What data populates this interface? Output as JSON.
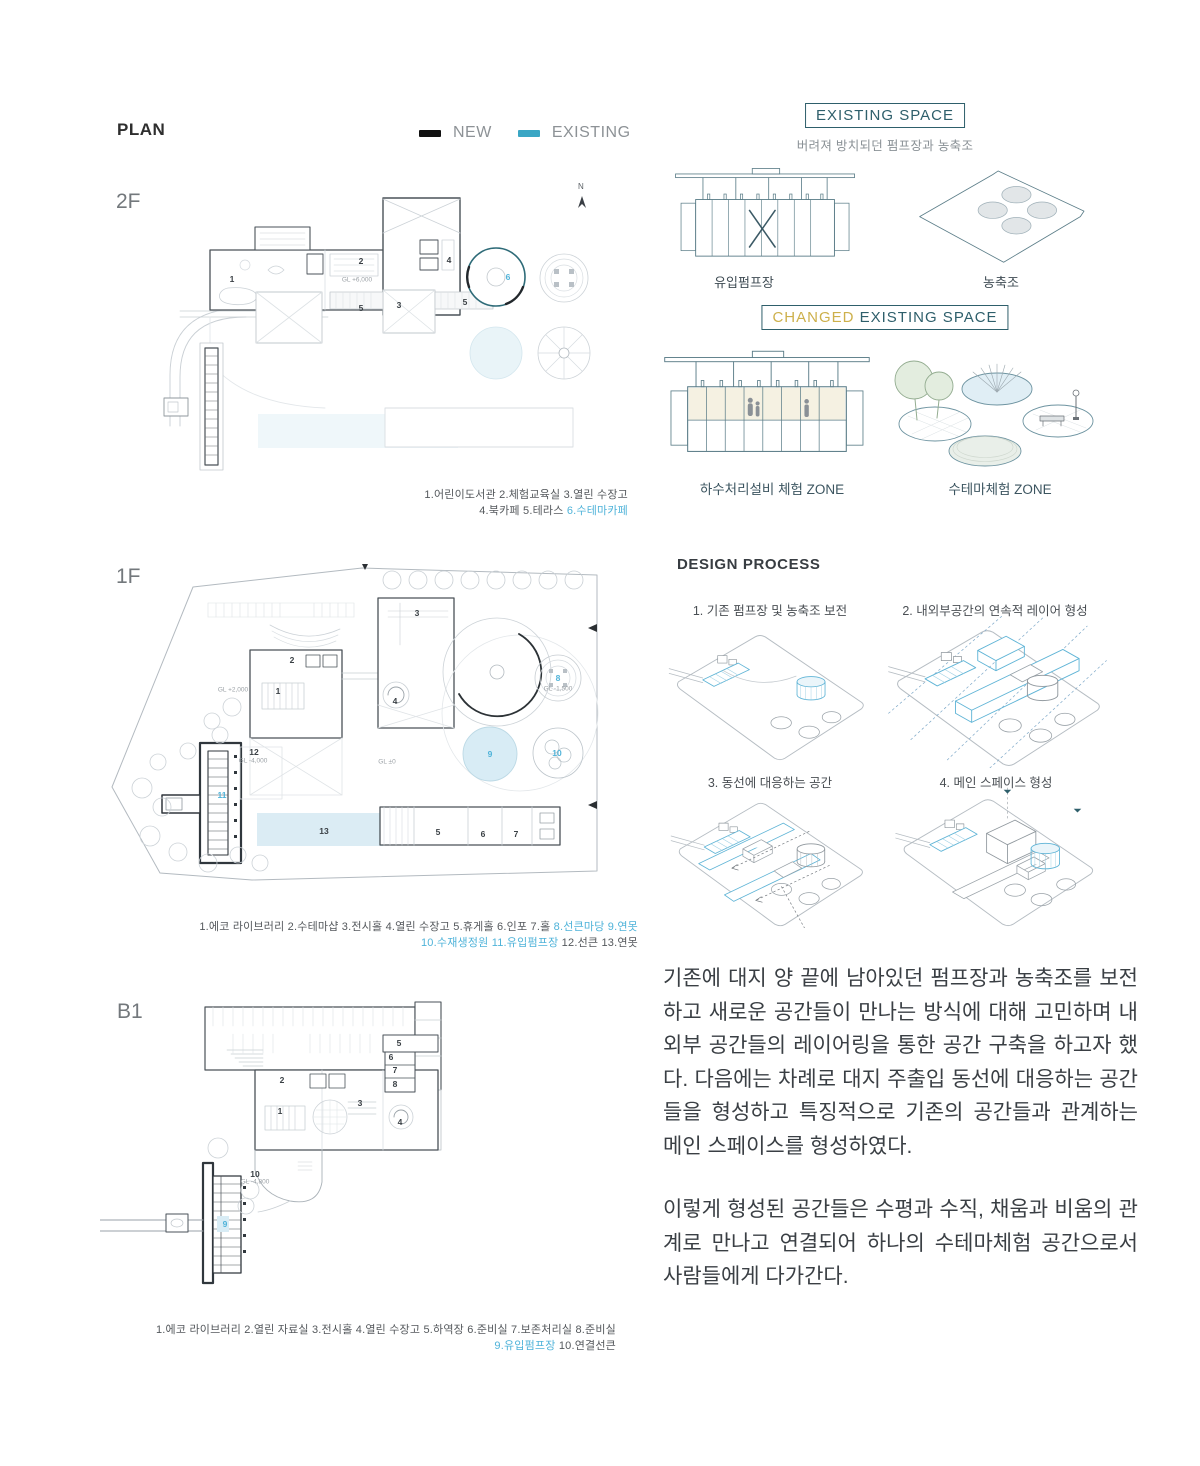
{
  "colors": {
    "accent_blue": "#4fb3d9",
    "teal_dark": "#2e5f6b",
    "gold": "#cdb04b",
    "legend_new": "#111111",
    "legend_existing": "#3aa6c4"
  },
  "header": {
    "title": "PLAN",
    "legend": {
      "new_label": "NEW",
      "existing_label": "EXISTING"
    }
  },
  "plans": {
    "f2": {
      "label": "2F",
      "north": "N",
      "gl": "GL +6,000",
      "markers": [
        "1",
        "2",
        "3",
        "4",
        "5",
        "5",
        "6"
      ],
      "caption_line1": "1.어린이도서관 2.체험교육실 3.열린 수장고",
      "caption_line2_pre": "4.북카페 5.테라스 ",
      "caption_line2_blue": "6.수테마카페"
    },
    "f1": {
      "label": "1F",
      "gl": [
        "GL +2,000",
        "GL ±0",
        "GL -1,500",
        "GL -4,000"
      ],
      "markers": [
        "1",
        "2",
        "3",
        "4",
        "5",
        "6",
        "7",
        "8",
        "9",
        "10",
        "11",
        "12",
        "13"
      ],
      "caption_line1_pre": "1.에코 라이브러리 2.수테마샵 3.전시홀 4.열린 수장고 5.휴게홀 6.인포 7.홀 ",
      "caption_line1_blue": "8.선큰마당 9.연못",
      "caption_line2_blue": "10.수재생정원 11.유입펌프장",
      "caption_line2_post": " 12.선큰 13.연못"
    },
    "b1": {
      "label": "B1",
      "gl": "GL -4,800",
      "markers": [
        "1",
        "2",
        "3",
        "4",
        "5",
        "6",
        "7",
        "8",
        "9",
        "10"
      ],
      "caption_line1": "1.에코 라이브러리 2.열린 자료실 3.전시홀 4.열린 수장고 5.하역장 6.준비실 7.보존처리실 8.준비실",
      "caption_line2_blue": "9.유입펌프장",
      "caption_line2_post": " 10.연결선큰"
    }
  },
  "existing_space": {
    "title": "EXISTING SPACE",
    "subtitle": "버려져 방치되던 펌프장과 농축조",
    "pump_label": "유입펌프장",
    "tank_label": "농축조"
  },
  "changed_space": {
    "title_changed": "CHANGED",
    "title_rest": " EXISTING SPACE",
    "zone1_label": "하수처리설비 체험 ZONE",
    "zone2_label": "수테마체험 ZONE"
  },
  "design_process": {
    "title": "DESIGN PROCESS",
    "steps": [
      "1. 기존 펌프장 및 농축조 보전",
      "2. 내외부공간의 연속적 레이어 형성",
      "3. 동선에 대응하는 공간",
      "4. 메인 스페이스 형성"
    ]
  },
  "description": {
    "paragraph1": "기존에 대지 양 끝에 남아있던 펌프장과 농축조를 보전하고 새로운 공간들이 만나는 방식에 대해 고민하며 내외부 공간들의 레이어링을 통한 공간 구축을 하고자 했다. 다음에는 차례로 대지 주출입 동선에 대응하는 공간들을 형성하고 특징적으로 기존의 공간들과 관계하는 메인 스페이스를 형성하였다.",
    "paragraph2": "이렇게 형성된 공간들은 수평과 수직, 채움과 비움의 관계로 만나고 연결되어 하나의 수테마체험 공간으로서 사람들에게 다가간다."
  }
}
